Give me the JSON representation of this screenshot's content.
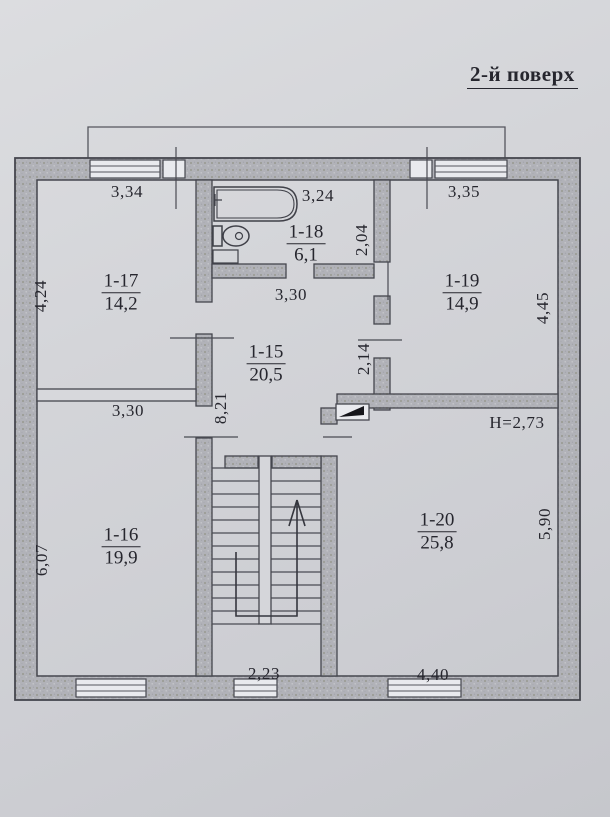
{
  "title": "2-й поверх",
  "plan": {
    "rooms": {
      "r117": {
        "id": "1-17",
        "area": "14,2"
      },
      "r118": {
        "id": "1-18",
        "area": "6,1"
      },
      "r119": {
        "id": "1-19",
        "area": "14,9"
      },
      "r115": {
        "id": "1-15",
        "area": "20,5"
      },
      "r116": {
        "id": "1-16",
        "area": "19,9"
      },
      "r120": {
        "id": "1-20",
        "area": "25,8"
      }
    },
    "dims": {
      "top_left": "3,34",
      "top_mid": "3,24",
      "top_right": "3,35",
      "left_upper": "4,24",
      "left_lower": "6,07",
      "right_upper": "4,45",
      "right_lower": "5,90",
      "bath_right": "2,04",
      "hall_top": "3,30",
      "hall_left": "8,21",
      "hall_right": "2,14",
      "room16_top": "3,30",
      "bottom_stair": "2,23",
      "bottom_right": "4,40",
      "ceiling_height": "Н=2,73"
    }
  }
}
